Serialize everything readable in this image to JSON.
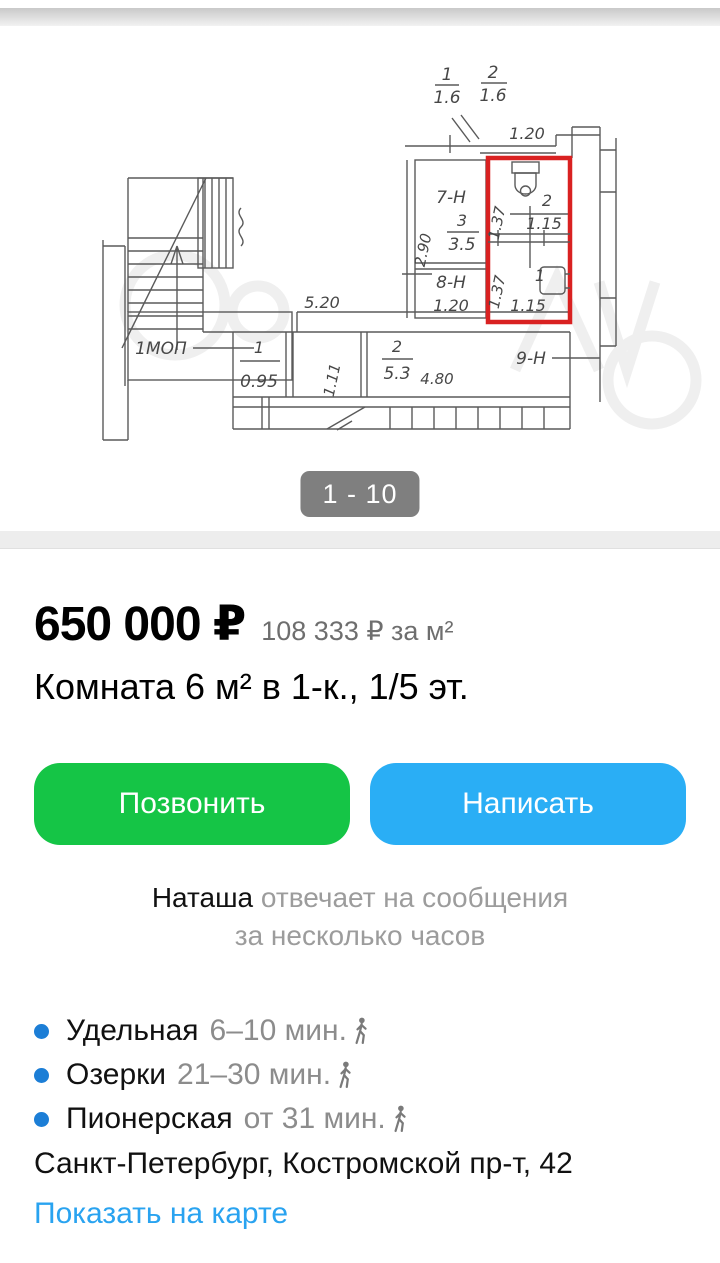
{
  "gallery": {
    "counter": "1 - 10"
  },
  "plan": {
    "frac1_num": "1",
    "frac1_den": "1.6",
    "frac2_num": "2",
    "frac2_den": "1.6",
    "dim_top": "1.20",
    "room7_label": "7-Н",
    "room7_num": "3",
    "room7_area": "3.5",
    "room7_dim": "2.90",
    "room8_label": "8-Н",
    "room8_dim": "1.20",
    "wc_num": "2",
    "wc_width": "1.15",
    "wc_depth": "1.37",
    "bath_num": "1",
    "bath_width": "1.15",
    "bath_depth": "1.37",
    "room9_label": "9-Н",
    "mop_label": "1МОП",
    "hall_num": "1",
    "hall_dim": "0.95",
    "hall_dim2": "1.11",
    "corridor_num": "2",
    "corridor_area": "5.3",
    "corridor_dim": "4.80",
    "corridor_len": "5.20",
    "highlight_color": "#d92121"
  },
  "listing": {
    "price": "650 000 ₽",
    "price_per_m2": "108 333 ₽ за м²",
    "title": "Комната 6 м² в 1-к., 1/5 эт."
  },
  "actions": {
    "call_label": "Позвонить",
    "write_label": "Написать"
  },
  "seller": {
    "name": "Наташа",
    "reply_line1": "отвечает на сообщения",
    "reply_line2": "за несколько часов"
  },
  "metro": [
    {
      "name": "Удельная",
      "time": "6–10 мин."
    },
    {
      "name": "Озерки",
      "time": "21–30 мин."
    },
    {
      "name": "Пионерская",
      "time": "от 31 мин."
    }
  ],
  "location": {
    "address": "Санкт-Петербург, Костромской пр-т, 42",
    "map_link": "Показать на карте"
  },
  "colors": {
    "call_green": "#15c546",
    "write_blue": "#2aaef5",
    "link_blue": "#29a3f0",
    "metro_bullet": "#1c7ed6",
    "highlight_red": "#d92121",
    "counter_bg": "rgba(0,0,0,0.5)"
  }
}
